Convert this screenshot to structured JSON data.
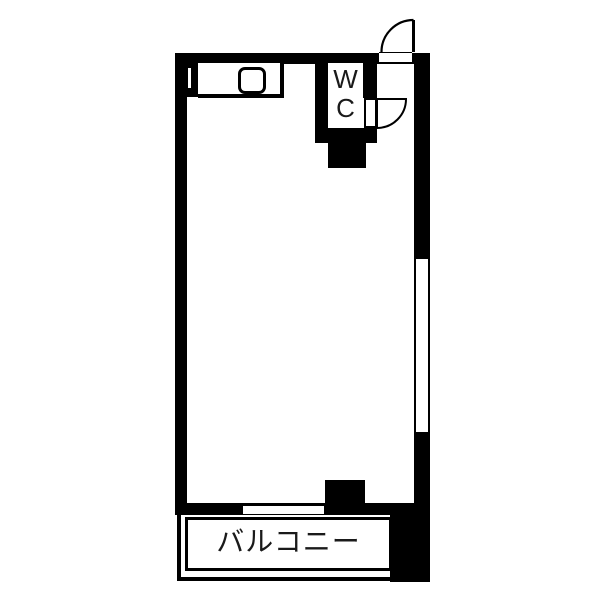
{
  "floorplan": {
    "wc": {
      "label_lines": [
        "W",
        "C"
      ]
    },
    "balcony": {
      "label": "バルコニー"
    },
    "colors": {
      "wall": "#000000",
      "background": "#ffffff",
      "text": "#1a1a1a"
    }
  }
}
